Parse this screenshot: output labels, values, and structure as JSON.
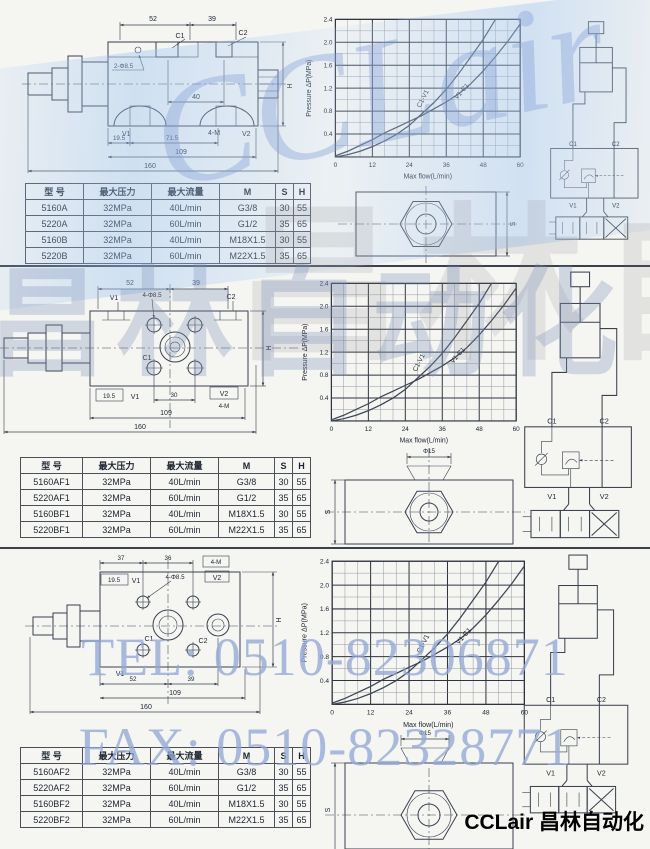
{
  "watermarks": {
    "brand_script": "CCLair",
    "brand_cn": "昌林自动化",
    "brand_cn_gray": "昌林自动化",
    "tel": "TEL: 0510-82306871",
    "fax": "FAX: 0510-82328771"
  },
  "footer": {
    "brand": "CCLair 昌林自动化"
  },
  "table_headers": [
    "型  号",
    "最大压力",
    "最大流量",
    "M",
    "S",
    "H"
  ],
  "chart_data": [
    {
      "type": "line",
      "title": "",
      "xlabel": "Max flow(L/min)",
      "ylabel": "Pressure  ΔP(MPa)",
      "xlim": [
        0,
        60
      ],
      "ylim": [
        0,
        2.4
      ],
      "xticks": [
        "0",
        "12",
        "24",
        "36",
        "48",
        "60"
      ],
      "yticks": [
        "0.4",
        "0.8",
        "1.2",
        "1.6",
        "2.0",
        "2.4"
      ],
      "grid": true,
      "minor_x": 4,
      "major_x": 12,
      "minor_y": 0.2,
      "major_y": 0.4,
      "series": [
        {
          "name": "C1-V1",
          "x": [
            0,
            4,
            8,
            12,
            16,
            20,
            24,
            28,
            32,
            36,
            40,
            44,
            48,
            52
          ],
          "y": [
            0,
            0.04,
            0.1,
            0.18,
            0.28,
            0.4,
            0.55,
            0.75,
            0.95,
            1.18,
            1.45,
            1.75,
            2.05,
            2.4
          ]
        },
        {
          "name": "V1-C1",
          "x": [
            0,
            4,
            8,
            12,
            16,
            20,
            24,
            28,
            32,
            36,
            40,
            44,
            48,
            52,
            56,
            60
          ],
          "y": [
            0.02,
            0.1,
            0.2,
            0.3,
            0.42,
            0.52,
            0.62,
            0.72,
            0.84,
            0.96,
            1.1,
            1.28,
            1.5,
            1.75,
            2.02,
            2.32
          ]
        }
      ]
    },
    {
      "type": "line",
      "title": "",
      "xlabel": "Max flow(L/min)",
      "ylabel": "Pressure  ΔP(MPa)",
      "xlim": [
        0,
        60
      ],
      "ylim": [
        0,
        2.4
      ],
      "xticks": [
        "0",
        "12",
        "24",
        "36",
        "48",
        "60"
      ],
      "yticks": [
        "0.4",
        "0.8",
        "1.2",
        "1.6",
        "2.0",
        "2.4"
      ],
      "grid": true,
      "minor_x": 4,
      "major_x": 12,
      "minor_y": 0.2,
      "major_y": 0.4,
      "series": [
        {
          "name": "C1-V1",
          "x": [
            0,
            4,
            8,
            12,
            16,
            20,
            24,
            28,
            32,
            36,
            40,
            44,
            48,
            52
          ],
          "y": [
            0,
            0.04,
            0.1,
            0.18,
            0.28,
            0.4,
            0.55,
            0.75,
            0.95,
            1.18,
            1.45,
            1.75,
            2.05,
            2.4
          ]
        },
        {
          "name": "V1-C1",
          "x": [
            0,
            4,
            8,
            12,
            16,
            20,
            24,
            28,
            32,
            36,
            40,
            44,
            48,
            52,
            56,
            60
          ],
          "y": [
            0.02,
            0.1,
            0.2,
            0.3,
            0.42,
            0.52,
            0.62,
            0.72,
            0.84,
            0.96,
            1.1,
            1.28,
            1.5,
            1.75,
            2.02,
            2.32
          ]
        }
      ]
    },
    {
      "type": "line",
      "title": "",
      "xlabel": "Max flow(L/min)",
      "ylabel": "Pressure  ΔP(MPa)",
      "xlim": [
        0,
        60
      ],
      "ylim": [
        0,
        2.4
      ],
      "xticks": [
        "0",
        "12",
        "24",
        "36",
        "48",
        "60"
      ],
      "yticks": [
        "0.4",
        "0.8",
        "1.2",
        "1.6",
        "2.0",
        "2.4"
      ],
      "grid": true,
      "minor_x": 4,
      "major_x": 12,
      "minor_y": 0.2,
      "major_y": 0.4,
      "series": [
        {
          "name": "C1-V1",
          "x": [
            0,
            4,
            8,
            12,
            16,
            20,
            24,
            28,
            32,
            36,
            40,
            44,
            48,
            52
          ],
          "y": [
            0,
            0.04,
            0.1,
            0.18,
            0.28,
            0.4,
            0.55,
            0.75,
            0.95,
            1.18,
            1.45,
            1.75,
            2.05,
            2.4
          ]
        },
        {
          "name": "V1-C1",
          "x": [
            0,
            4,
            8,
            12,
            16,
            20,
            24,
            28,
            32,
            36,
            40,
            44,
            48,
            52,
            56,
            60
          ],
          "y": [
            0.02,
            0.1,
            0.2,
            0.3,
            0.42,
            0.52,
            0.62,
            0.72,
            0.84,
            0.96,
            1.1,
            1.28,
            1.5,
            1.75,
            2.02,
            2.32
          ]
        }
      ]
    }
  ],
  "sections": [
    {
      "drawing": {
        "dim_52": "52",
        "dim_39": "39",
        "c1": "C1",
        "c2": "C2",
        "holes": "2-Φ8.5",
        "dim_40": "40",
        "v1": "V1",
        "m": "4-M",
        "v2": "V2",
        "dim_19_5": "19.5",
        "dim_71_5": "71.5",
        "dim_109": "109",
        "dim_160": "160",
        "h": "H"
      },
      "hex": {
        "s": "S"
      },
      "schematic": {
        "c1": "C1",
        "c2": "C2",
        "v1": "V1",
        "v2": "V2"
      },
      "table": {
        "rows": [
          [
            "5160A",
            "32MPa",
            "40L/min",
            "G3/8",
            "30",
            "55"
          ],
          [
            "5220A",
            "32MPa",
            "60L/min",
            "G1/2",
            "35",
            "65"
          ],
          [
            "5160B",
            "32MPa",
            "40L/min",
            "M18X1.5",
            "30",
            "55"
          ],
          [
            "5220B",
            "32MPa",
            "60L/min",
            "M22X1.5",
            "35",
            "65"
          ]
        ]
      }
    },
    {
      "drawing": {
        "dim_52": "52",
        "dim_39": "39",
        "v1_top": "V1",
        "holes": "4-Φ8.5",
        "c2": "C2",
        "c1": "C1",
        "dim_19_5": "19.5",
        "v1": "V1",
        "dim_30": "30",
        "v2": "V2",
        "m": "4-M",
        "dim_109": "109",
        "dim_160": "160",
        "h": "H"
      },
      "hex": {
        "phi": "Φ15",
        "s": "S"
      },
      "schematic": {
        "c1": "C1",
        "c2": "C2",
        "v1": "V1",
        "v2": "V2"
      },
      "table": {
        "rows": [
          [
            "5160AF1",
            "32MPa",
            "40L/min",
            "G3/8",
            "30",
            "55"
          ],
          [
            "5220AF1",
            "32MPa",
            "60L/min",
            "G1/2",
            "35",
            "65"
          ],
          [
            "5160BF1",
            "32MPa",
            "40L/min",
            "M18X1.5",
            "30",
            "55"
          ],
          [
            "5220BF1",
            "32MPa",
            "60L/min",
            "M22X1.5",
            "35",
            "65"
          ]
        ]
      }
    },
    {
      "drawing": {
        "dim_37": "37",
        "dim_36": "36",
        "m": "4-M",
        "dim_19_5": "19.5",
        "v1_top": "V1",
        "holes": "4-Φ8.5",
        "v2_top": "V2",
        "c1": "C1",
        "c2": "C2",
        "v1": "V1",
        "dim_52": "52",
        "dim_39": "39",
        "dim_109": "109",
        "dim_160": "160",
        "h": "H"
      },
      "hex": {
        "phi": "Φ15",
        "s": "S"
      },
      "schematic": {
        "c1": "C1",
        "c2": "C2",
        "v1": "V1",
        "v2": "V2"
      },
      "table": {
        "rows": [
          [
            "5160AF2",
            "32MPa",
            "40L/min",
            "G3/8",
            "30",
            "55"
          ],
          [
            "5220AF2",
            "32MPa",
            "60L/min",
            "G1/2",
            "35",
            "65"
          ],
          [
            "5160BF2",
            "32MPa",
            "40L/min",
            "M18X1.5",
            "30",
            "55"
          ],
          [
            "5220BF2",
            "32MPa",
            "60L/min",
            "M22X1.5",
            "35",
            "65"
          ]
        ]
      }
    }
  ]
}
